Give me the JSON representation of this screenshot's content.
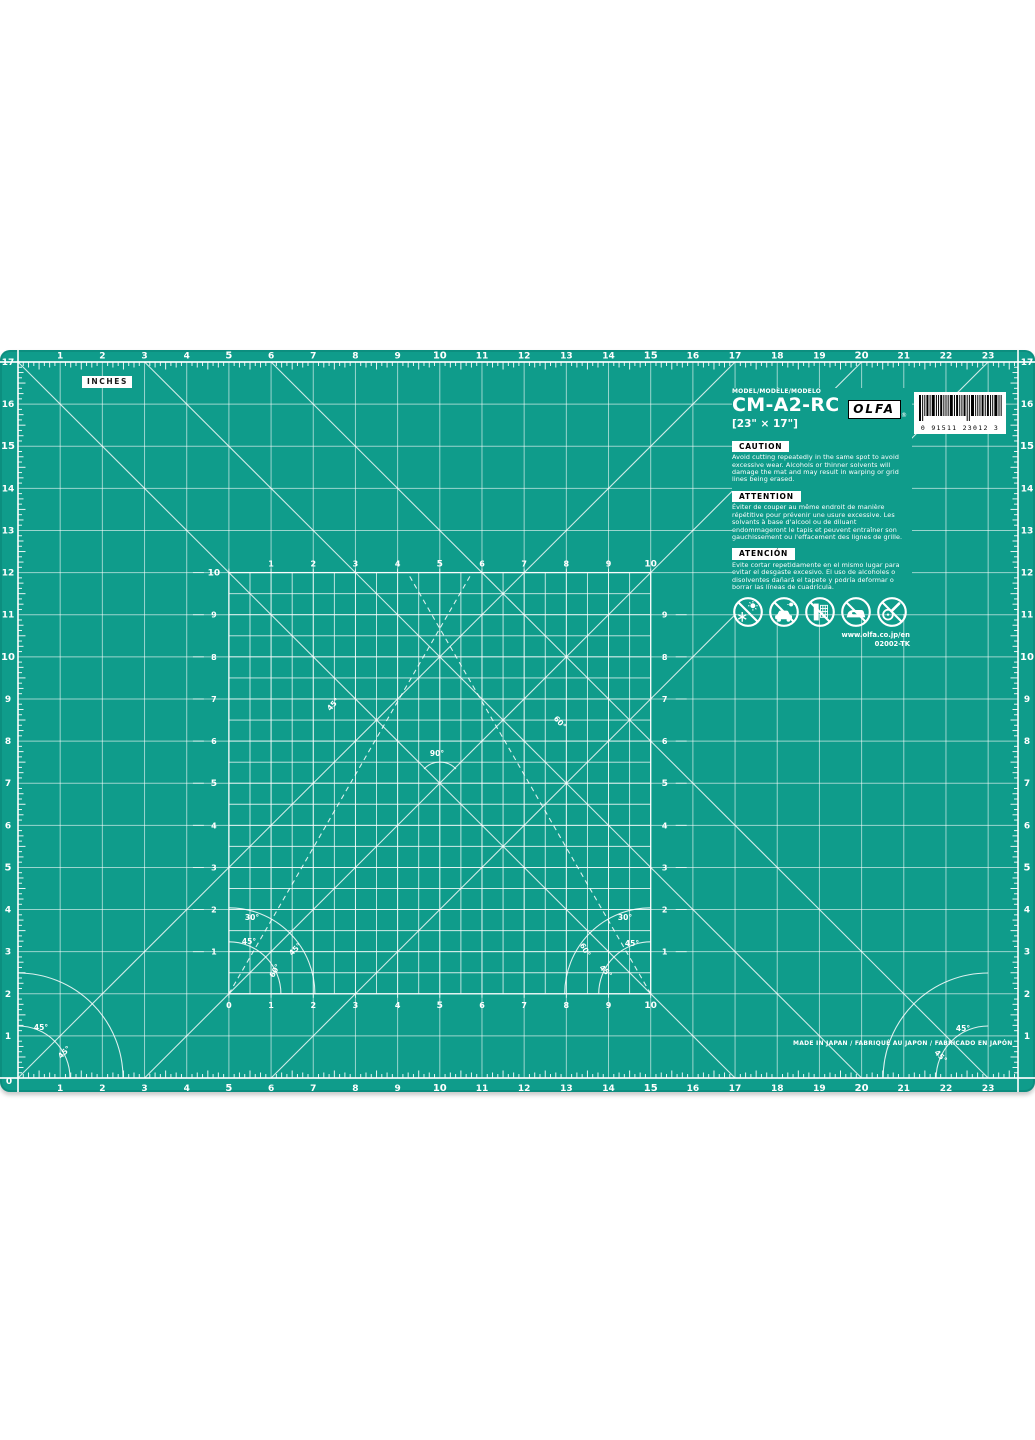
{
  "page": {
    "background": "#ffffff"
  },
  "mat": {
    "units_label": "INCHES",
    "made_in": "MADE IN JAPAN / FABRIQUÉ AU JAPON / FABRICADO EN JAPÓN",
    "colors": {
      "mat_green": "#0f9c8b",
      "line_white": "#ffffff",
      "badge_bg": "#ffffff",
      "badge_text": "#000000"
    },
    "rulers": {
      "top": [
        "1",
        "2",
        "3",
        "4",
        "5",
        "6",
        "7",
        "8",
        "9",
        "10",
        "11",
        "12",
        "13",
        "14",
        "15",
        "16",
        "17",
        "18",
        "19",
        "20",
        "21",
        "22",
        "23"
      ],
      "bottom": [
        "1",
        "2",
        "3",
        "4",
        "5",
        "6",
        "7",
        "8",
        "9",
        "10",
        "11",
        "12",
        "13",
        "14",
        "15",
        "16",
        "17",
        "18",
        "19",
        "20",
        "21",
        "22",
        "23"
      ],
      "left": [
        "17",
        "16",
        "15",
        "14",
        "13",
        "12",
        "11",
        "10",
        "9",
        "8",
        "7",
        "6",
        "5",
        "4",
        "3",
        "2",
        "1"
      ],
      "right": [
        "17",
        "16",
        "15",
        "14",
        "13",
        "12",
        "11",
        "10",
        "9",
        "8",
        "7",
        "6",
        "5",
        "4",
        "3",
        "2",
        "1"
      ],
      "corner_zero": "0",
      "bold": [
        "5",
        "10",
        "15",
        "20"
      ]
    },
    "inner_grid": {
      "top": [
        "1",
        "2",
        "3",
        "4",
        "5",
        "6",
        "7",
        "8",
        "9",
        "10"
      ],
      "bottom": [
        "0",
        "1",
        "2",
        "3",
        "4",
        "5",
        "6",
        "7",
        "8",
        "9",
        "10"
      ],
      "left": [
        "10",
        "9",
        "8",
        "7",
        "6",
        "5",
        "4",
        "3",
        "2",
        "1"
      ],
      "right": [
        "9",
        "8",
        "7",
        "6",
        "5",
        "4",
        "3",
        "2",
        "1"
      ],
      "bold": [
        "5",
        "10"
      ]
    },
    "angle_labels": {
      "right_angle": "90°",
      "deg45": "45°",
      "deg30": "30°",
      "deg60": "60°"
    },
    "label": {
      "model_caption": "MODEL/MODÈLE/MODELO",
      "model": "CM-A2-RC",
      "size": "[23\" × 17\"]",
      "brand": "OLFA",
      "registered": "®",
      "barcode_digits": "0 91511 23012 3",
      "website": "www.olfa.co.jp/en",
      "item_code": "02002-TK",
      "cautions": [
        {
          "title": "CAUTION",
          "text": "Avoid cutting repeatedly in the same spot to avoid excessive wear. Alcohols or thinner solvents will damage the mat and may result in warping or grid lines being erased."
        },
        {
          "title": "ATTENTION",
          "text": "Éviter de couper au même endroit de manière répétitive pour prévenir une usure excessive. Les solvants à base d'alcool ou de diluant endommageront le tapis et peuvent entraîner son gauchissement ou l'effacement des lignes de grille."
        },
        {
          "title": "ATENCIÓN",
          "text": "Evite cortar repetidamente en el mismo lugar para evitar el desgaste excesivo. El uso de alcoholes o disolventes dañará el tapete y podría deformar o borrar las líneas de cuadrícula."
        }
      ],
      "icons": [
        "no-sun-frost-icon",
        "no-hot-car-icon",
        "no-window-heat-icon",
        "no-iron-icon",
        "no-rotary-cutter-icon"
      ]
    }
  }
}
